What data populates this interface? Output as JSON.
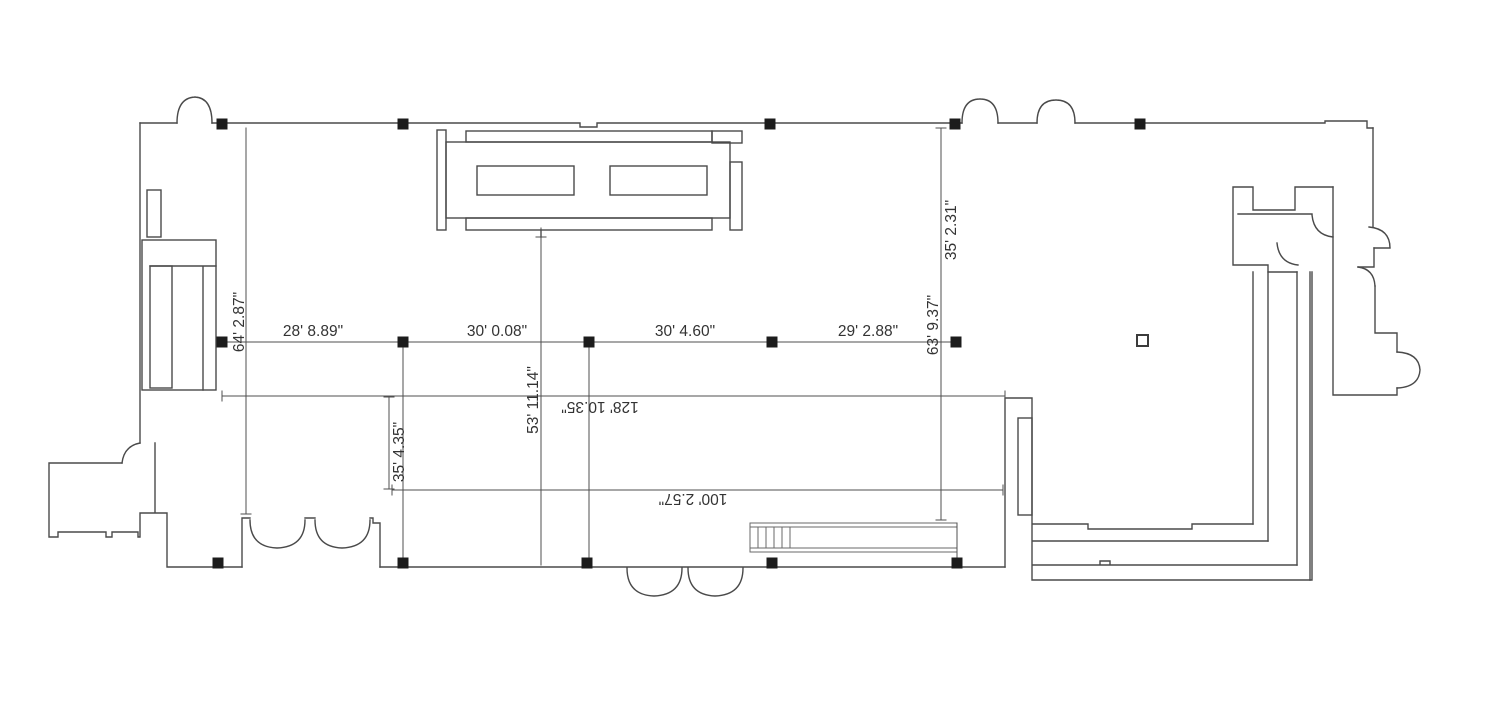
{
  "drawing": {
    "type": "architectural-floor-plan",
    "background_color": "#ffffff",
    "wall_color": "#4a4a4a",
    "column_color": "#1c1c1c",
    "text_color": "#333333",
    "dimensions": {
      "bay_1": "28' 8.89\"",
      "bay_2": "30' 0.08\"",
      "bay_3": "30' 4.60\"",
      "bay_4": "29' 2.88\"",
      "left_height": "64' 2.87\"",
      "right_height": "63' 9.37\"",
      "right_upper_height": "35' 2.31\"",
      "center_height": "53' 11.14\"",
      "lower_left_height": "35' 4.35\"",
      "overall_width": "128' 10.35\"",
      "lower_width": "100' 2.57\""
    }
  }
}
